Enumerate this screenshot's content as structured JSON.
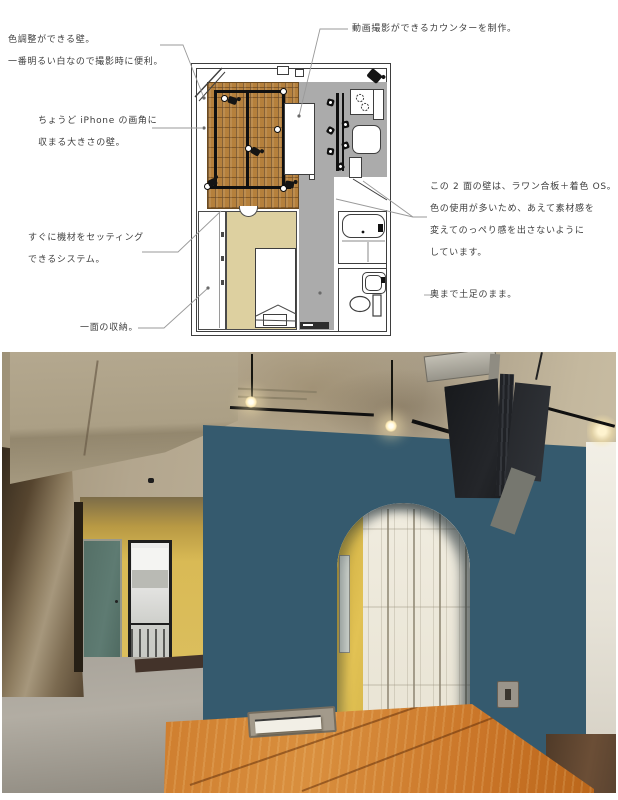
{
  "floor_plan": {
    "annotations": {
      "color_wall": {
        "line1": "色調整ができる壁。",
        "line2": "一番明るい白なので撮影時に便利。"
      },
      "video_counter": {
        "line1": "動画撮影ができるカウンターを制作。"
      },
      "iphone_wall": {
        "line1": "ちょうど iPhone の画角に",
        "line2": "収まる大きさの壁。"
      },
      "equipment_system": {
        "line1": "すぐに機材をセッティング",
        "line2": "できるシステム。"
      },
      "storage": {
        "line1": "一面の収納。"
      },
      "two_walls": {
        "line1": "この 2 面の壁は、ラワン合板＋着色 OS。",
        "line2": "色の使用が多いため、あえて素材感を",
        "line3": "変えてのっぺり感を出さないように",
        "line4": "しています。"
      },
      "doma": {
        "line1": "奥まで土足のまま。"
      }
    }
  },
  "palette": {
    "plan_brick_floor": "#b5803c",
    "plan_gray_floor": "#ababab",
    "plan_bedroom_beige": "#ddd0a0",
    "photo_blue_wall": "#355a6e",
    "photo_yellow_wall": "#dcbc4e",
    "photo_teal_door": "#5c7a71",
    "photo_table_wood": "#c97a2c",
    "photo_concrete_ceiling": "#b3a68e",
    "photo_white_doors": "#ece8db"
  }
}
